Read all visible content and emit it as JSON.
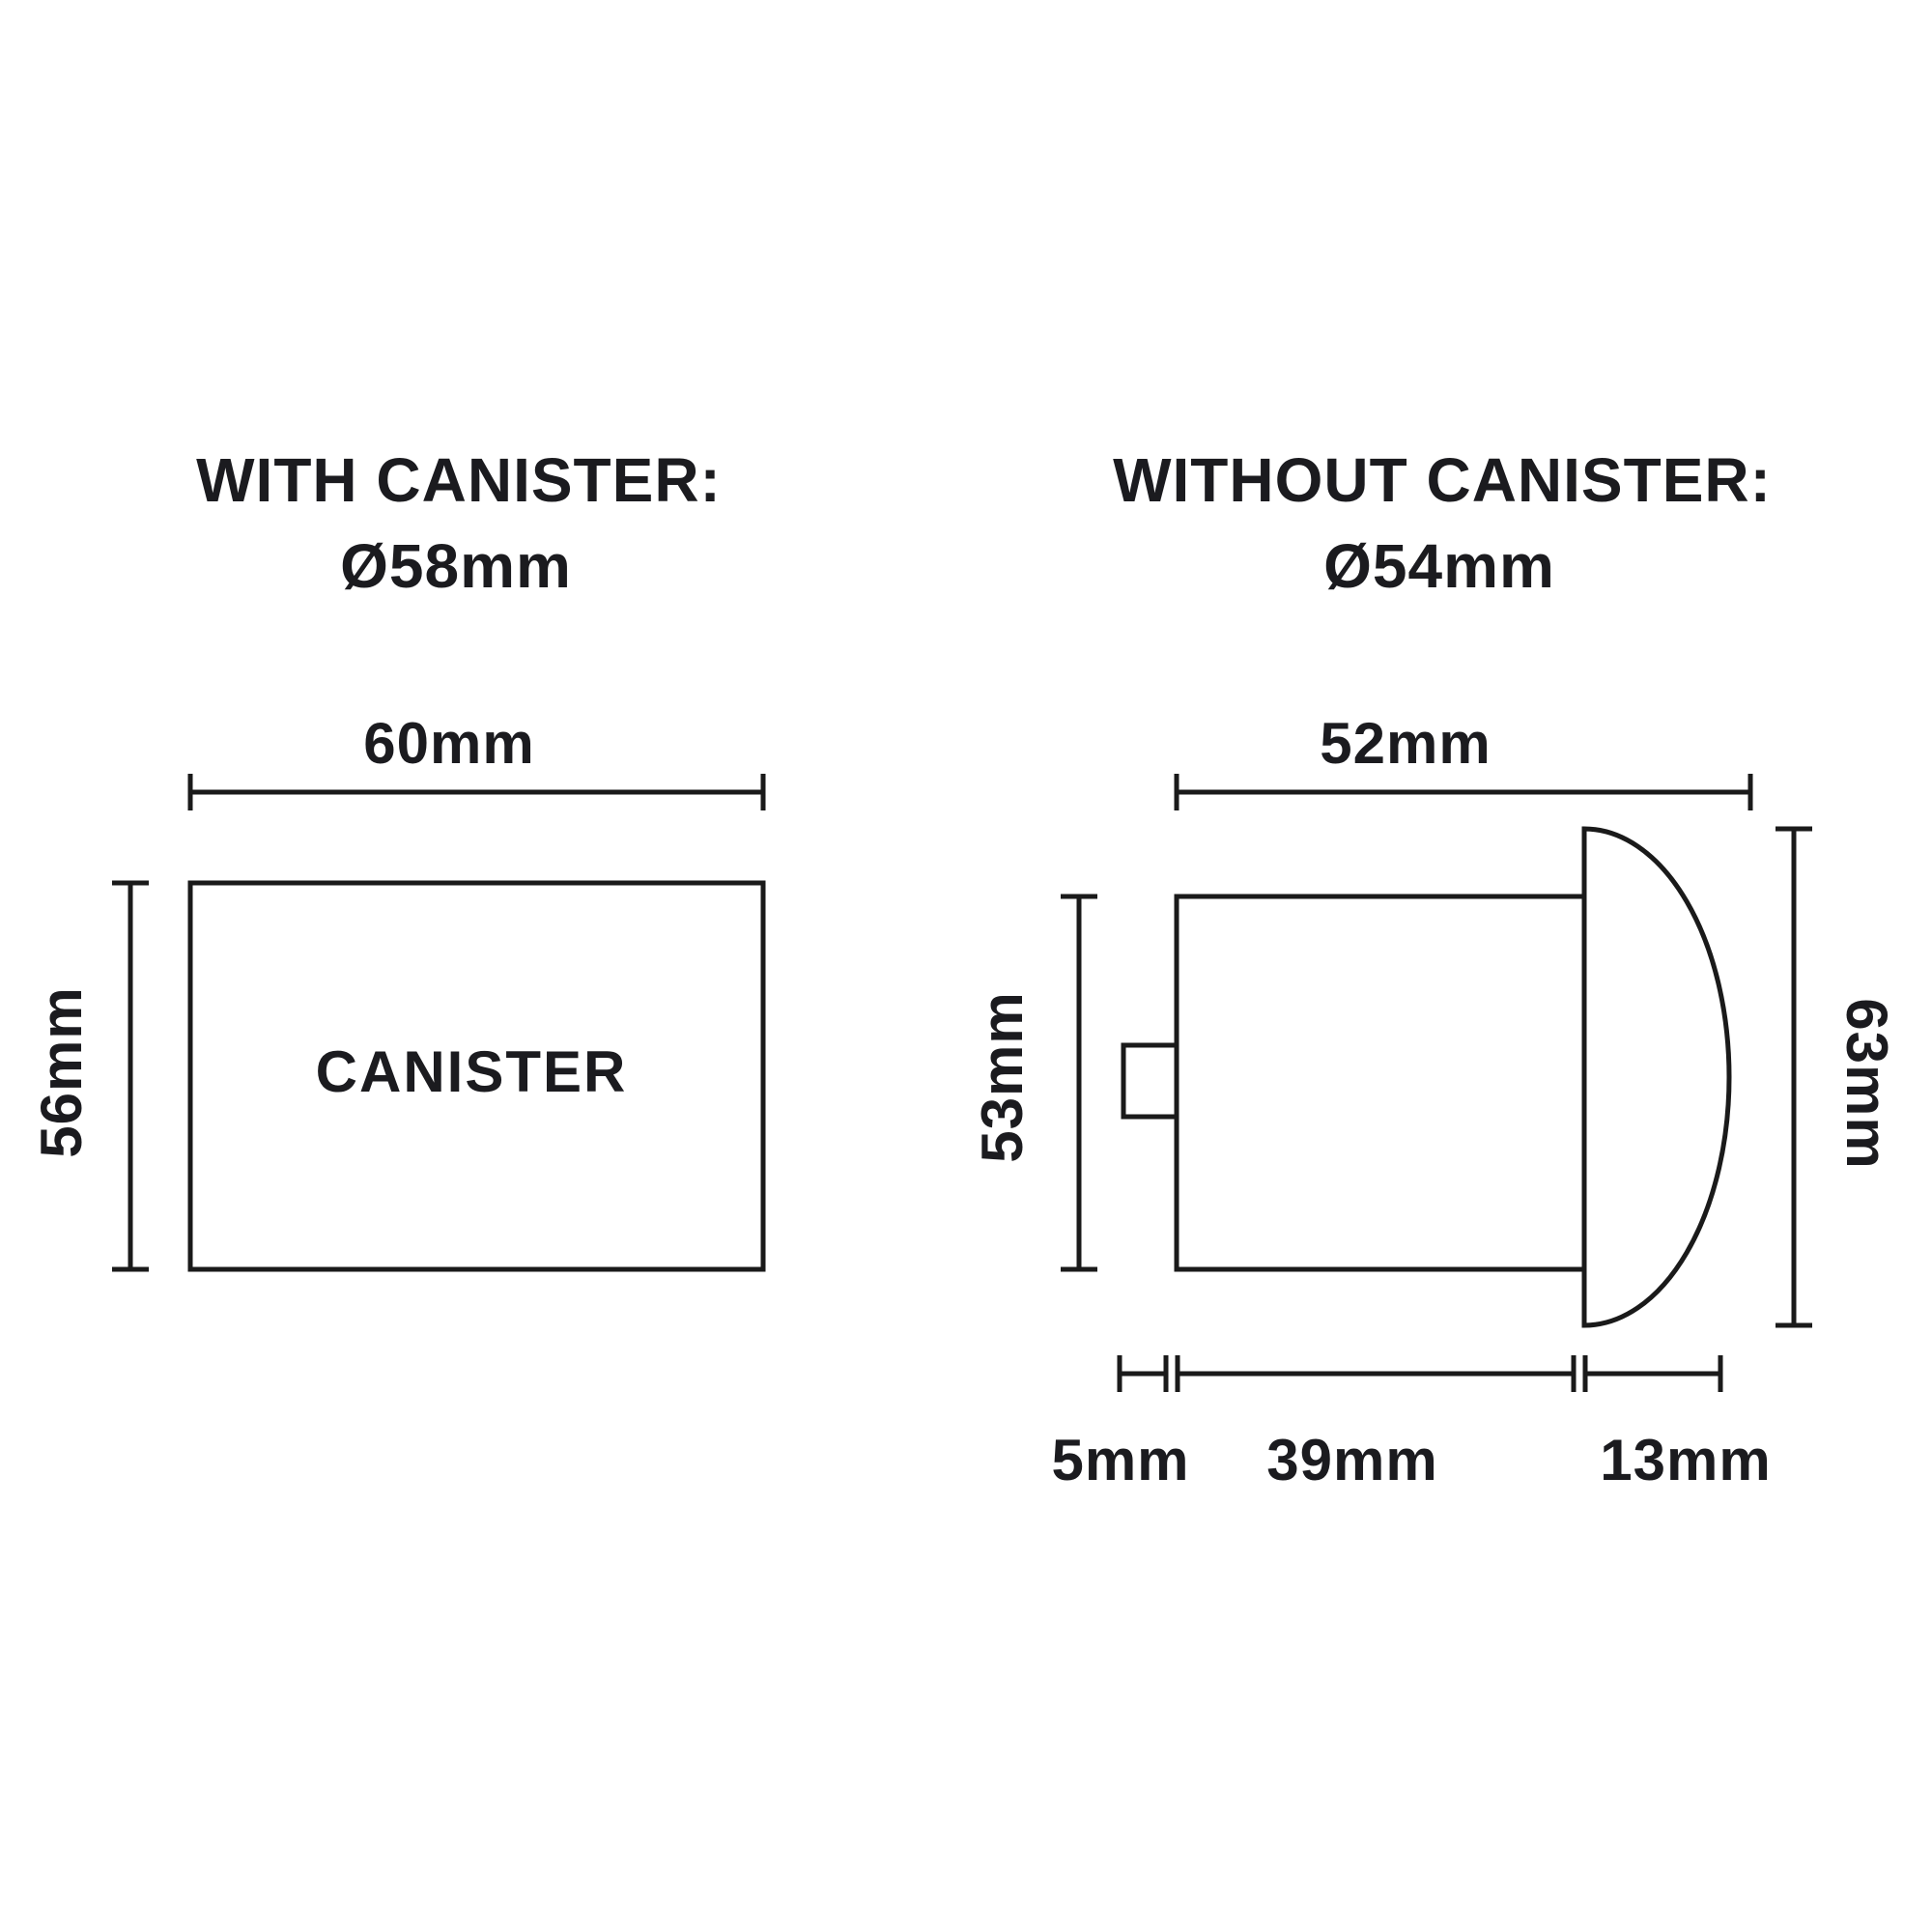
{
  "colors": {
    "line": "#1a1a1a",
    "text": "#1b1b1f",
    "background": "#ffffff"
  },
  "left_diagram": {
    "title": "WITH CANISTER:",
    "diameter": "Ø58mm",
    "width_label": "60mm",
    "height_label": "56mm",
    "body_label": "CANISTER"
  },
  "right_diagram": {
    "title": "WITHOUT CANISTER:",
    "diameter": "Ø54mm",
    "width_label": "52mm",
    "body_height_label": "53mm",
    "overall_height_label": "63mm",
    "nub_depth_label": "5mm",
    "body_depth_label": "39mm",
    "dome_depth_label": "13mm"
  }
}
